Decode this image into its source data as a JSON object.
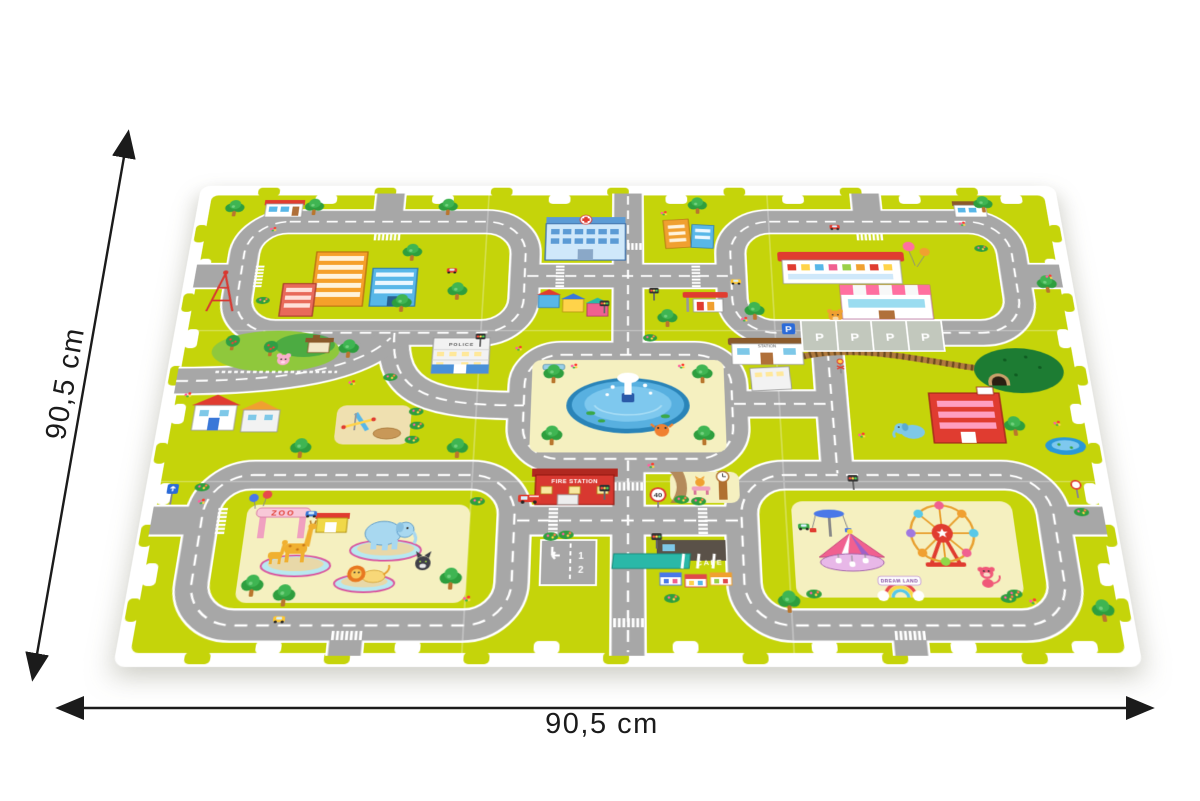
{
  "dimensions": {
    "height_label": "90,5 cm",
    "width_label": "90,5 cm"
  },
  "mat": {
    "tiles": {
      "rows": 3,
      "cols": 3
    },
    "labels": {
      "zoo": "ZOO",
      "fire_station": "FIRE STATION",
      "cafe": "CAFE",
      "police": "POLICE",
      "station": "STATION",
      "dream_land": "DREAM LAND",
      "parking_letter": "P",
      "parking_sign": "P",
      "speed_limit": "40",
      "parking_spot_1": "1",
      "parking_spot_2": "2"
    },
    "colors": {
      "foam_edge": "#ffffff",
      "grass": "#c5d40a",
      "road": "#a7a7a7",
      "road_marking": "#ffffff",
      "park_ground": "#f5f0c0",
      "water": "#58b0e0",
      "railway": "#b07a3e",
      "fire_station_red": "#d83830",
      "hospital_blue": "#cfe8fa"
    }
  }
}
